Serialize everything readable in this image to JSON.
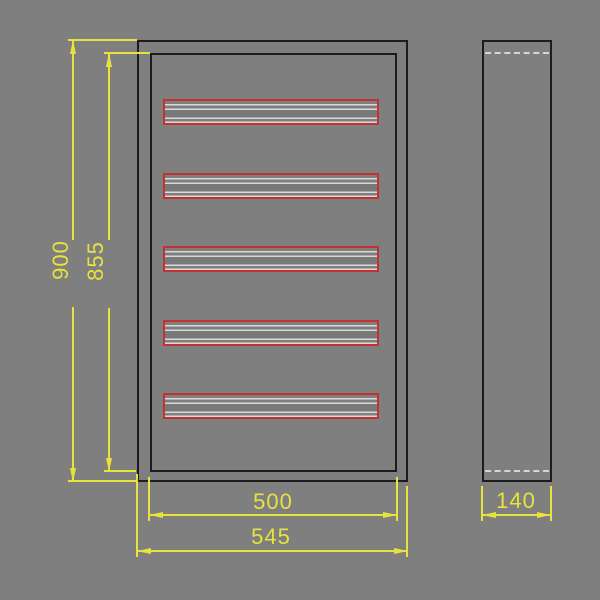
{
  "front_view": {
    "slot_count": 5,
    "slot_tops": [
      99,
      173,
      246,
      320,
      393
    ]
  },
  "dims": {
    "outer_height": {
      "label": "900"
    },
    "inner_height": {
      "label": "855"
    },
    "inner_width": {
      "label": "500"
    },
    "outer_width": {
      "label": "545"
    },
    "depth": {
      "label": "140"
    }
  },
  "colors": {
    "background": "#7f7f7f",
    "frame_line": "#1c1c1c",
    "slot_red": "#c23232",
    "dimension_yellow": "#e8e23c",
    "light_gray_line": "#d9d9d9"
  }
}
